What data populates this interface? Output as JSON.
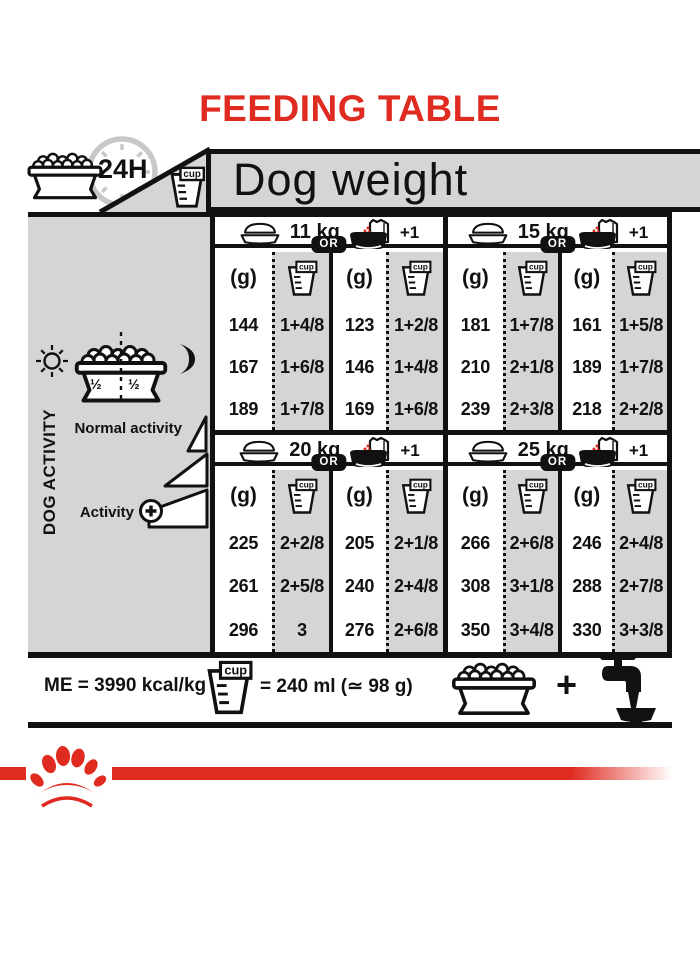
{
  "title": "FEEDING TABLE",
  "colors": {
    "red": "#e02b20",
    "gray": "#d5d5d5"
  },
  "header": {
    "daily": "24H",
    "dog_weight": "Dog weight"
  },
  "sidebar": {
    "axis": "DOG ACTIVITY",
    "half_left": "½",
    "half_right": "½",
    "normal": "Normal activity",
    "active": "Activity"
  },
  "table": {
    "g_label": "(g)",
    "cup_label": "cup",
    "or": "OR",
    "plus_one": "+1",
    "sections": [
      {
        "weight": "11 kg",
        "rows": [
          [
            "144",
            "1+4/8",
            "123",
            "1+2/8"
          ],
          [
            "167",
            "1+6/8",
            "146",
            "1+4/8"
          ],
          [
            "189",
            "1+7/8",
            "169",
            "1+6/8"
          ]
        ]
      },
      {
        "weight": "15 kg",
        "rows": [
          [
            "181",
            "1+7/8",
            "161",
            "1+5/8"
          ],
          [
            "210",
            "2+1/8",
            "189",
            "1+7/8"
          ],
          [
            "239",
            "2+3/8",
            "218",
            "2+2/8"
          ]
        ]
      },
      {
        "weight": "20 kg",
        "rows": [
          [
            "225",
            "2+2/8",
            "205",
            "2+1/8"
          ],
          [
            "261",
            "2+5/8",
            "240",
            "2+4/8"
          ],
          [
            "296",
            "3",
            "276",
            "2+6/8"
          ]
        ]
      },
      {
        "weight": "25 kg",
        "rows": [
          [
            "266",
            "2+6/8",
            "246",
            "2+4/8"
          ],
          [
            "308",
            "3+1/8",
            "288",
            "2+7/8"
          ],
          [
            "350",
            "3+4/8",
            "330",
            "3+3/8"
          ]
        ]
      }
    ]
  },
  "footer": {
    "me": "ME = 3990 kcal/kg",
    "equiv": "= 240 ml (≃ 98 g)",
    "plus": "+"
  }
}
